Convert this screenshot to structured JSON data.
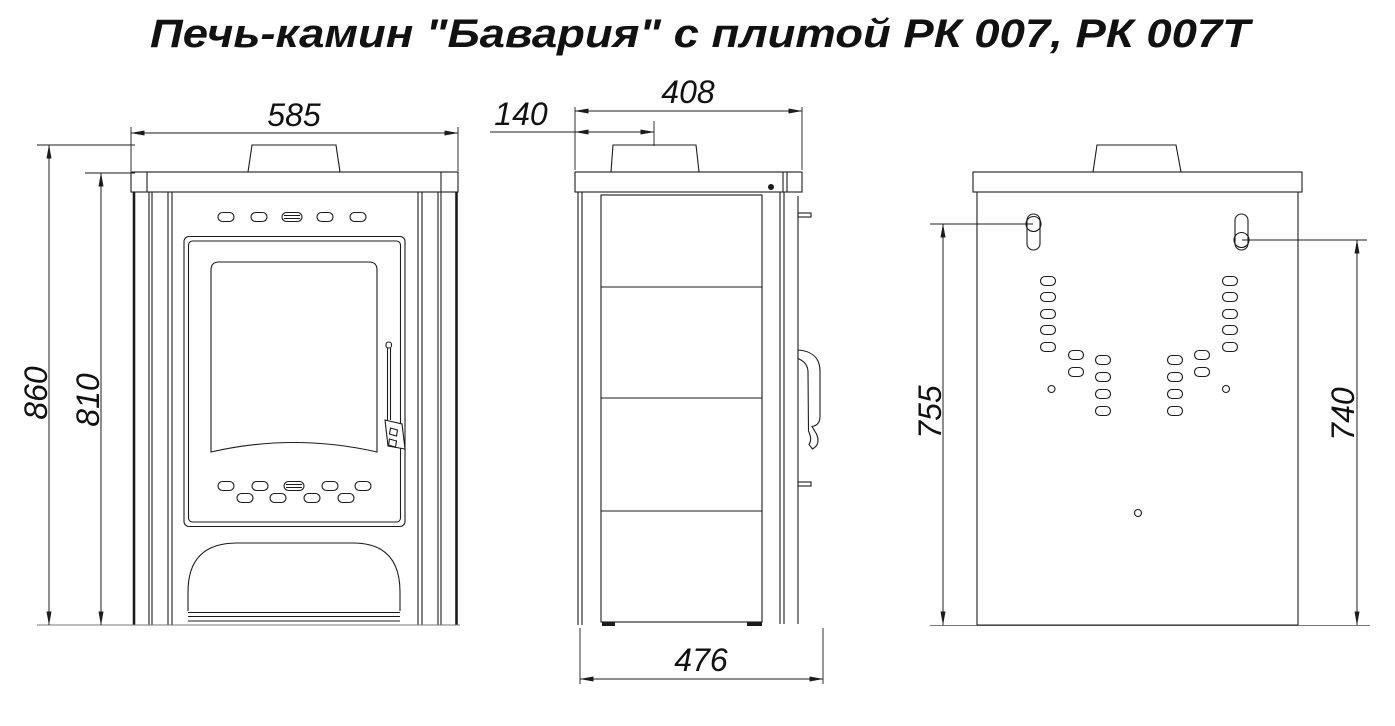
{
  "title": "Печь-камин \"Бавария\" с плитой РК 007, РК 007Т",
  "drawing": {
    "dims": {
      "front_width": "585",
      "height_total": "860",
      "height_body": "810",
      "depth_top": "408",
      "flue_offset": "140",
      "depth_total": "476",
      "mount_left": "755",
      "mount_right": "740"
    },
    "colors": {
      "line": "#1c1c1c",
      "ground": "#777777",
      "background": "#ffffff"
    }
  }
}
